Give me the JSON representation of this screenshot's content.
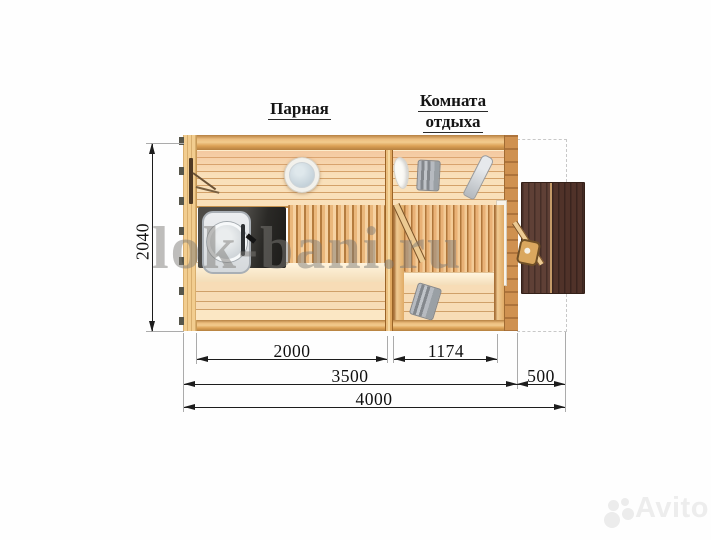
{
  "room_labels": {
    "steam": "Парная",
    "rest_line1": "Комната",
    "rest_line2": "отдыха"
  },
  "dims": {
    "height": "2040",
    "steam_width": "2000",
    "rest_width": "1174",
    "main_width": "3500",
    "terrace_depth": "500",
    "total_width": "4000"
  },
  "watermark": {
    "site": "lok-bani.ru",
    "brand": "Avito"
  },
  "colors": {
    "wood_wall": "#e8b473",
    "wood_planks": "#f7dcb6",
    "bench_slats": "#eab77b",
    "terrace_table": "#553830",
    "stove_body": "#e7e9eb",
    "dimension_ink": "#1d1d1d"
  }
}
